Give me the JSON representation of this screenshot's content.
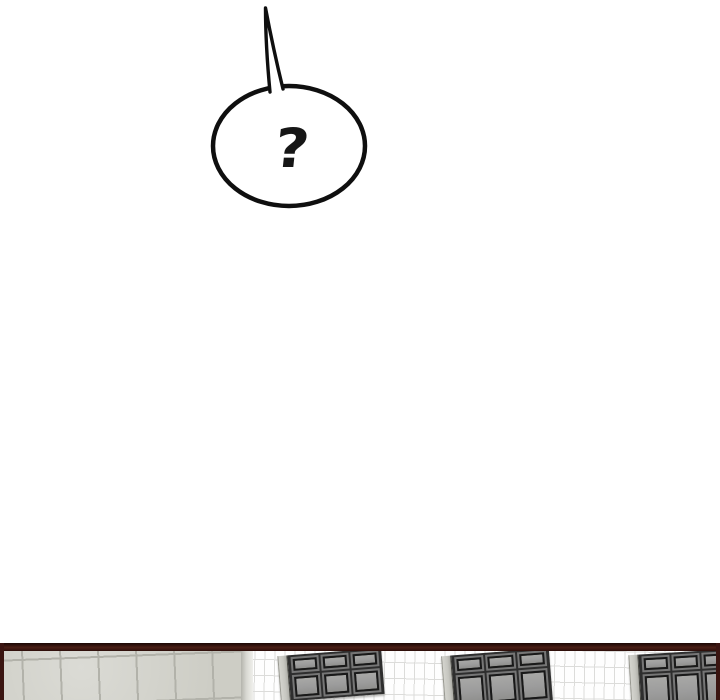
{
  "colors": {
    "ink": "#161616",
    "bubble_fill": "#ffffff",
    "bubble_stroke": "#0f0f0f",
    "panel_border": "#3a1511",
    "concrete_base": "#cdcdc5",
    "concrete_grout": "#b2b2aa",
    "tile_base": "#fefefe",
    "tile_grout": "#dcdcda",
    "window_frame": "#2e2e2e",
    "window_frame_dark": "#191919",
    "window_ridge": "#767676",
    "window_glass": "#9c9c9c",
    "window_jamb": "#c6c6c0"
  },
  "speech_bubble": {
    "text": "?"
  },
  "panel": {
    "scene": {
      "windows": [
        {
          "left": 279,
          "top": 9,
          "width": 104,
          "height": 46,
          "cols": 3,
          "rows": 2,
          "tilt": -4.5
        },
        {
          "left": 443,
          "top": 9,
          "width": 108,
          "height": 54,
          "cols": 3,
          "rows": 2,
          "tilt": -4.5
        },
        {
          "left": 630,
          "top": 9,
          "width": 104,
          "height": 58,
          "cols": 3,
          "rows": 2,
          "tilt": -3.5
        }
      ]
    }
  }
}
